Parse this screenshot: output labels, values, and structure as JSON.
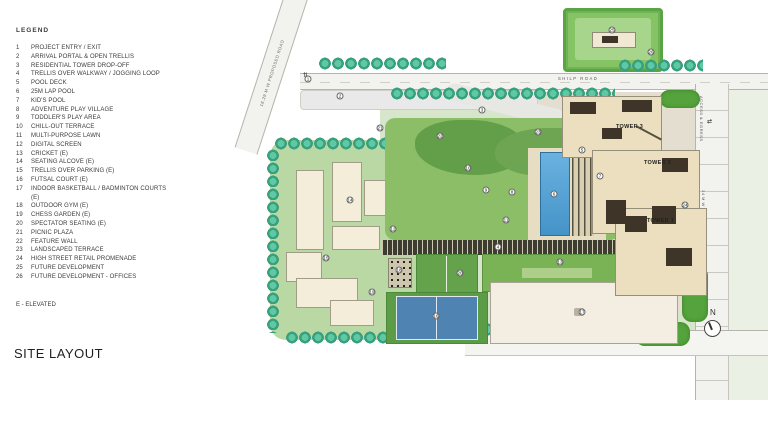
{
  "page": {
    "title": "SITE LAYOUT"
  },
  "legend": {
    "title": "LEGEND",
    "note": "E - ELEVATED",
    "items": [
      {
        "num": "1",
        "label": "PROJECT ENTRY / EXIT"
      },
      {
        "num": "2",
        "label": "ARRIVAL PORTAL & OPEN TRELLIS"
      },
      {
        "num": "3",
        "label": "RESIDENTIAL TOWER DROP-OFF"
      },
      {
        "num": "4",
        "label": "TRELLIS OVER WALKWAY / JOGGING LOOP"
      },
      {
        "num": "5",
        "label": "POOL DECK"
      },
      {
        "num": "6",
        "label": "25M LAP POOL"
      },
      {
        "num": "7",
        "label": "KID'S POOL"
      },
      {
        "num": "8",
        "label": "ADVENTURE PLAY VILLAGE"
      },
      {
        "num": "9",
        "label": "TODDLER'S PLAY AREA"
      },
      {
        "num": "10",
        "label": "CHILL-OUT TERRACE"
      },
      {
        "num": "11",
        "label": "MULTI-PURPOSE LAWN"
      },
      {
        "num": "12",
        "label": "DIGITAL SCREEN"
      },
      {
        "num": "13",
        "label": "CRICKET (E)"
      },
      {
        "num": "14",
        "label": "SEATING ALCOVE (E)"
      },
      {
        "num": "15",
        "label": "TRELLIS OVER PARKING (E)"
      },
      {
        "num": "16",
        "label": "FUTSAL COURT (E)"
      },
      {
        "num": "17",
        "label": "INDOOR BASKETBALL / BADMINTON COURTS (E)"
      },
      {
        "num": "18",
        "label": "OUTDOOR GYM (E)"
      },
      {
        "num": "19",
        "label": "CHESS GARDEN (E)"
      },
      {
        "num": "20",
        "label": "SPECTATOR SEATING (E)"
      },
      {
        "num": "21",
        "label": "PICNIC PLAZA"
      },
      {
        "num": "22",
        "label": "FEATURE WALL"
      },
      {
        "num": "23",
        "label": "LANDSCAPED TERRACE"
      },
      {
        "num": "24",
        "label": "HIGH STREET RETAIL PROMENADE"
      },
      {
        "num": "25",
        "label": "FUTURE DEVELOPMENT"
      },
      {
        "num": "26",
        "label": "FUTURE DEVELOPMENT - OFFICES"
      }
    ]
  },
  "plan": {
    "towers": [
      {
        "label": "TOWER 3"
      },
      {
        "label": "TOWER 2"
      },
      {
        "label": "TOWER 1"
      }
    ],
    "roads": {
      "diagonal_label": "18.29 M W PROPOSED ROAD",
      "top_label": "SHILP ROAD",
      "bottom_label": "SHILP ROAD",
      "right_top_label": "ACCESS & EGRESS",
      "right_bottom_label": "24 M W ROAD"
    },
    "compass_label": "N",
    "entry_arrows_glyph": "⇅",
    "egress_arrows_glyph": "⇄",
    "badges": [
      {
        "n": "1",
        "x": 78,
        "y": 79
      },
      {
        "n": "2",
        "x": 110,
        "y": 96
      },
      {
        "n": "3",
        "x": 252,
        "y": 110
      },
      {
        "n": "4",
        "x": 268,
        "y": 247
      },
      {
        "n": "5",
        "x": 352,
        "y": 150
      },
      {
        "n": "6",
        "x": 324,
        "y": 194
      },
      {
        "n": "7",
        "x": 370,
        "y": 176
      },
      {
        "n": "8",
        "x": 282,
        "y": 192
      },
      {
        "n": "9",
        "x": 256,
        "y": 190
      },
      {
        "n": "10",
        "x": 238,
        "y": 168
      },
      {
        "n": "11",
        "x": 276,
        "y": 220
      },
      {
        "n": "12",
        "x": 163,
        "y": 229
      },
      {
        "n": "13",
        "x": 330,
        "y": 262
      },
      {
        "n": "14",
        "x": 120,
        "y": 200
      },
      {
        "n": "15",
        "x": 96,
        "y": 258
      },
      {
        "n": "16",
        "x": 206,
        "y": 316
      },
      {
        "n": "17",
        "x": 352,
        "y": 312
      },
      {
        "n": "18",
        "x": 169,
        "y": 270
      },
      {
        "n": "19",
        "x": 142,
        "y": 292
      },
      {
        "n": "20",
        "x": 230,
        "y": 273
      },
      {
        "n": "21",
        "x": 150,
        "y": 128
      },
      {
        "n": "22",
        "x": 210,
        "y": 136
      },
      {
        "n": "23",
        "x": 308,
        "y": 132
      },
      {
        "n": "24",
        "x": 455,
        "y": 205
      },
      {
        "n": "25",
        "x": 382,
        "y": 30
      },
      {
        "n": "26",
        "x": 421,
        "y": 52
      }
    ],
    "colors": {
      "tree_teal": "#4db893",
      "lawn_green": "#8cbe67",
      "dark_landscape": "#639e49",
      "pool_blue": "#58a7d8",
      "court_blue": "#4f83b2",
      "tower_cream": "#ecdfc0",
      "roof_dark": "#3e3428",
      "road_gray": "#f2f2ef",
      "parcel_green": "#86c364"
    }
  }
}
